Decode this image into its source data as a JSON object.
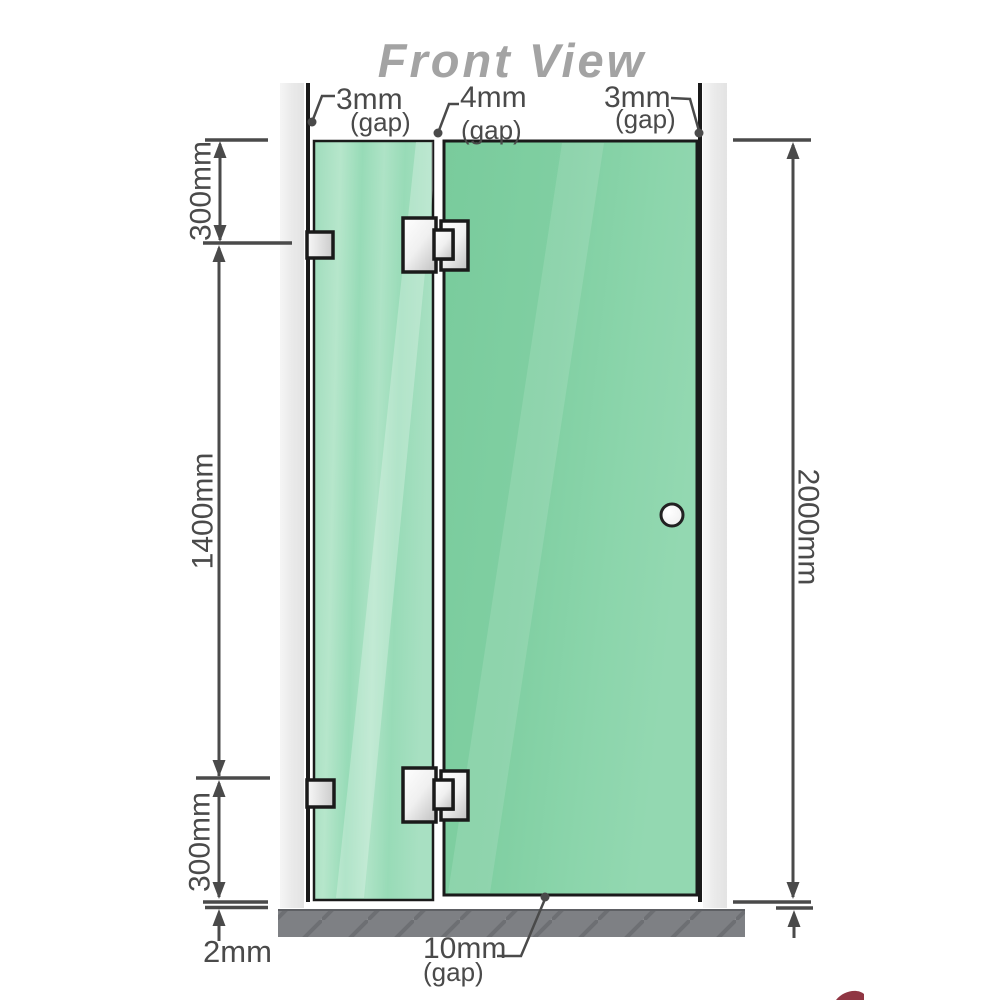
{
  "title": "Front View",
  "labels": {
    "gap_top_left": {
      "value": "3mm",
      "qualifier": "(gap)"
    },
    "gap_top_middle": {
      "value": "4mm",
      "qualifier": "(gap)"
    },
    "gap_top_right": {
      "value": "3mm",
      "qualifier": "(gap)"
    },
    "segment_top": "300mm",
    "segment_middle": "1400mm",
    "segment_bottom": "300mm",
    "total_height": "2000mm",
    "floor_gap": "2mm",
    "door_floor_gap": {
      "value": "10mm",
      "qualifier": "(gap)"
    }
  },
  "colors": {
    "title_color": "#a3a3a3",
    "dimension_color": "#4a4a4a",
    "glass_fixed_color": "#a5dfc0",
    "glass_door_color": "#7dcda0",
    "wall_channel_color": "#ebebeb",
    "floor_color": "#7e8084",
    "outline_color": "#1a1a1a",
    "hardware_color": "#f2f2f2",
    "watermark_color": "#7c1322"
  }
}
